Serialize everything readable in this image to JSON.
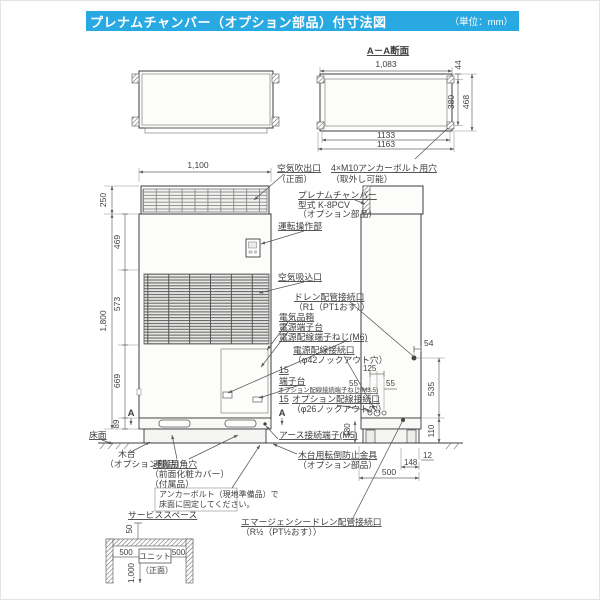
{
  "header": {
    "title": "プレナムチャンバー（オプション部品）付寸法図",
    "unit_note": "（単位：mm）",
    "accent_color": "#29a9e1"
  },
  "aa": {
    "title": "A－A断面",
    "w_top": "1,083",
    "flange": "44",
    "inner_h": "380",
    "outer_h": "468",
    "bolt_w": "1133",
    "overall_w": "1163"
  },
  "front": {
    "width": "1,100",
    "plenum_h": "250",
    "sec1": "469",
    "sec2": "573",
    "total_h": "1,800",
    "sec3": "669",
    "sec4": "89",
    "mark_left": "A",
    "mark_right": "A"
  },
  "side": {
    "drain_off": "54",
    "knock_span": "125",
    "knock_l": "55",
    "knock_r": "55",
    "drain_h": "535",
    "base_h": "110",
    "off_bottom": "12",
    "foot": "148",
    "depth": "500",
    "earth_h": "180"
  },
  "labels": {
    "air_outlet": "空気吹出口",
    "air_outlet2": "（正面）",
    "anchor_holes": "4×M10アンカーボルト用穴",
    "anchor_holes2": "（取外し可能）",
    "plenum1": "プレナムチャンバー",
    "plenum2": "型式 K-8PCV",
    "plenum3": "（オプション部品）",
    "control": "運転操作部",
    "air_inlet": "空気吸込口",
    "drain1": "ドレン配管接続口",
    "drain2": "（R1（PT1おす））",
    "elec_box": "電気品箱",
    "power_tb": "電源端子台",
    "power_screw": "電源配線端子ねじ(M6)",
    "power_port1": "電源配線接続口",
    "power_port2": "（φ42ノックアウト穴）",
    "dim15a": "15",
    "tb": "端子台",
    "opt_screw": "オプション配線接続端子ねじ(M3.5)",
    "dim15b": "15",
    "opt_port1": "オプション配線接続口",
    "opt_port2": "（φ26ノックアウト穴）",
    "earth": "アース接続端子(M5)",
    "floor": "床面",
    "base1": "木台",
    "base2": "（オプション部品）",
    "hole1": "運搬用角穴",
    "hole2": "（前面化粧カバー）",
    "hole3": "（付属品）",
    "anchor_note1": "アンカーボルト（現地準備品）で",
    "anchor_note2": "床面に固定してください。",
    "tip1": "木台用転倒防止金具",
    "tip2": "（オプション部品）",
    "emg1": "エマージェンシードレン配管接続口",
    "emg2": "（R½（PT½おす））"
  },
  "service": {
    "title": "サービススペース",
    "top": "50",
    "left": "500",
    "right": "500",
    "depth": "1,000",
    "unit": "ユニット",
    "front": "（正面）"
  }
}
